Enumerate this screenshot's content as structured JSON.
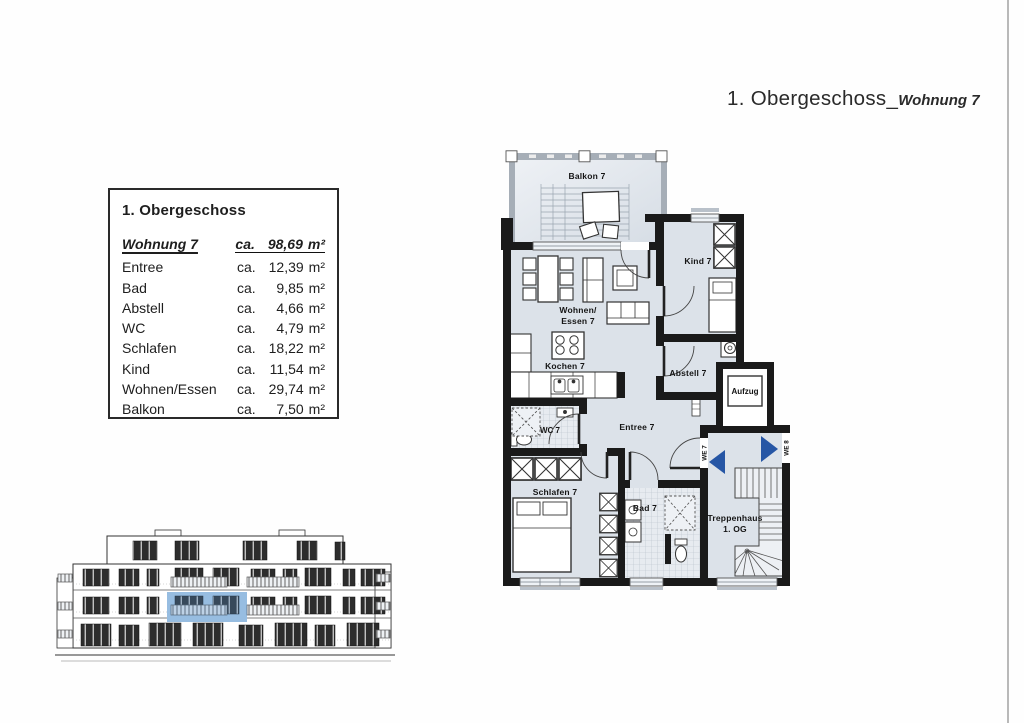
{
  "page": {
    "title": {
      "regular": "1. Obergeschoss_",
      "emphasis": "Wohnung 7"
    }
  },
  "legend": {
    "header": "1. Obergeschoss",
    "ca": "ca.",
    "unit": "m²",
    "total": {
      "label": "Wohnung 7",
      "area": "98,69"
    },
    "rows": [
      {
        "label": "Entree",
        "area": "12,39"
      },
      {
        "label": "Bad",
        "area": "9,85"
      },
      {
        "label": "Abstell",
        "area": "4,66"
      },
      {
        "label": "WC",
        "area": "4,79"
      },
      {
        "label": "Schlafen",
        "area": "18,22"
      },
      {
        "label": "Kind",
        "area": "11,54"
      },
      {
        "label": "Wohnen/Essen",
        "area": "29,74"
      },
      {
        "label": "Balkon",
        "area": "7,50"
      }
    ]
  },
  "floor_plan": {
    "labels": {
      "balkon": "Balkon 7",
      "kind": "Kind 7",
      "wohnen1": "Wohnen/",
      "wohnen2": "Essen 7",
      "kochen": "Kochen 7",
      "abstell": "Abstell 7",
      "aufzug": "Aufzug",
      "wc": "WC 7",
      "entree": "Entree 7",
      "schlafen": "Schlafen 7",
      "bad": "Bad 7",
      "trep1": "Treppenhaus",
      "trep2": "1. OG",
      "we7": "WE 7",
      "we8": "WE 8"
    },
    "colors": {
      "floor": "#dce2e9",
      "wall": "#1a1a1a",
      "arrow_blue": "#2656a5",
      "elevation_highlight": "#7fb0d9"
    }
  }
}
